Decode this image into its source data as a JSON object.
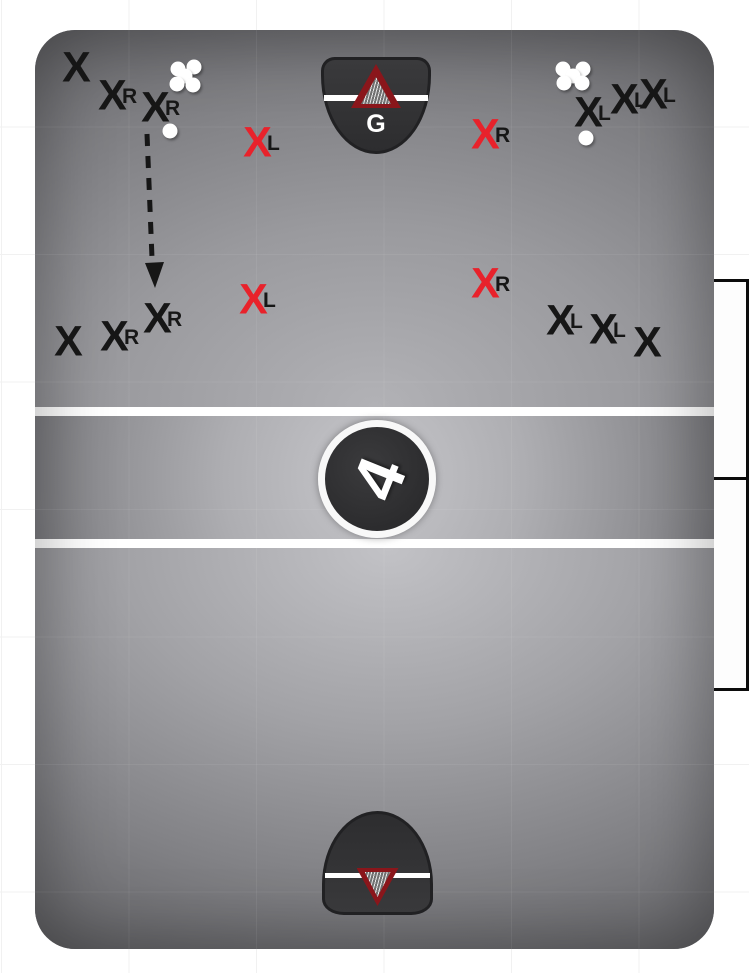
{
  "colors": {
    "player_red": "#e8222b",
    "player_black": "#161616",
    "label_black": "#161616",
    "net_red": "#8a161b",
    "line_white": "#ffffff"
  },
  "goal_top": {
    "goalie_label": "G"
  },
  "center_logo": {
    "glyph": "4"
  },
  "markers": [
    {
      "x": 76,
      "y": 68,
      "color": "black",
      "label": ""
    },
    {
      "x": 112,
      "y": 96,
      "color": "black",
      "label": "R"
    },
    {
      "x": 155,
      "y": 108,
      "color": "black",
      "label": "R"
    },
    {
      "x": 257,
      "y": 143,
      "color": "red",
      "label": "L"
    },
    {
      "x": 485,
      "y": 135,
      "color": "red",
      "label": "R"
    },
    {
      "x": 588,
      "y": 113,
      "color": "black",
      "label": "L"
    },
    {
      "x": 624,
      "y": 100,
      "color": "black",
      "label": "L"
    },
    {
      "x": 653,
      "y": 95,
      "color": "black",
      "label": "L"
    },
    {
      "x": 253,
      "y": 300,
      "color": "red",
      "label": "L"
    },
    {
      "x": 485,
      "y": 284,
      "color": "red",
      "label": "R"
    },
    {
      "x": 157,
      "y": 319,
      "color": "black",
      "label": "R"
    },
    {
      "x": 114,
      "y": 337,
      "color": "black",
      "label": "R"
    },
    {
      "x": 68,
      "y": 342,
      "color": "black",
      "label": ""
    },
    {
      "x": 560,
      "y": 321,
      "color": "black",
      "label": "L"
    },
    {
      "x": 603,
      "y": 330,
      "color": "black",
      "label": "L"
    },
    {
      "x": 647,
      "y": 343,
      "color": "black",
      "label": ""
    }
  ],
  "balls": [
    {
      "x": 178,
      "y": 69
    },
    {
      "x": 194,
      "y": 67
    },
    {
      "x": 185,
      "y": 76
    },
    {
      "x": 177,
      "y": 84
    },
    {
      "x": 193,
      "y": 85
    },
    {
      "x": 170,
      "y": 131
    },
    {
      "x": 563,
      "y": 69
    },
    {
      "x": 583,
      "y": 69
    },
    {
      "x": 573,
      "y": 76
    },
    {
      "x": 564,
      "y": 83
    },
    {
      "x": 582,
      "y": 83
    },
    {
      "x": 586,
      "y": 138
    }
  ],
  "arrow": {
    "line": "M147,134 L152,258",
    "head_points": "155,288 145,263 164,262"
  }
}
